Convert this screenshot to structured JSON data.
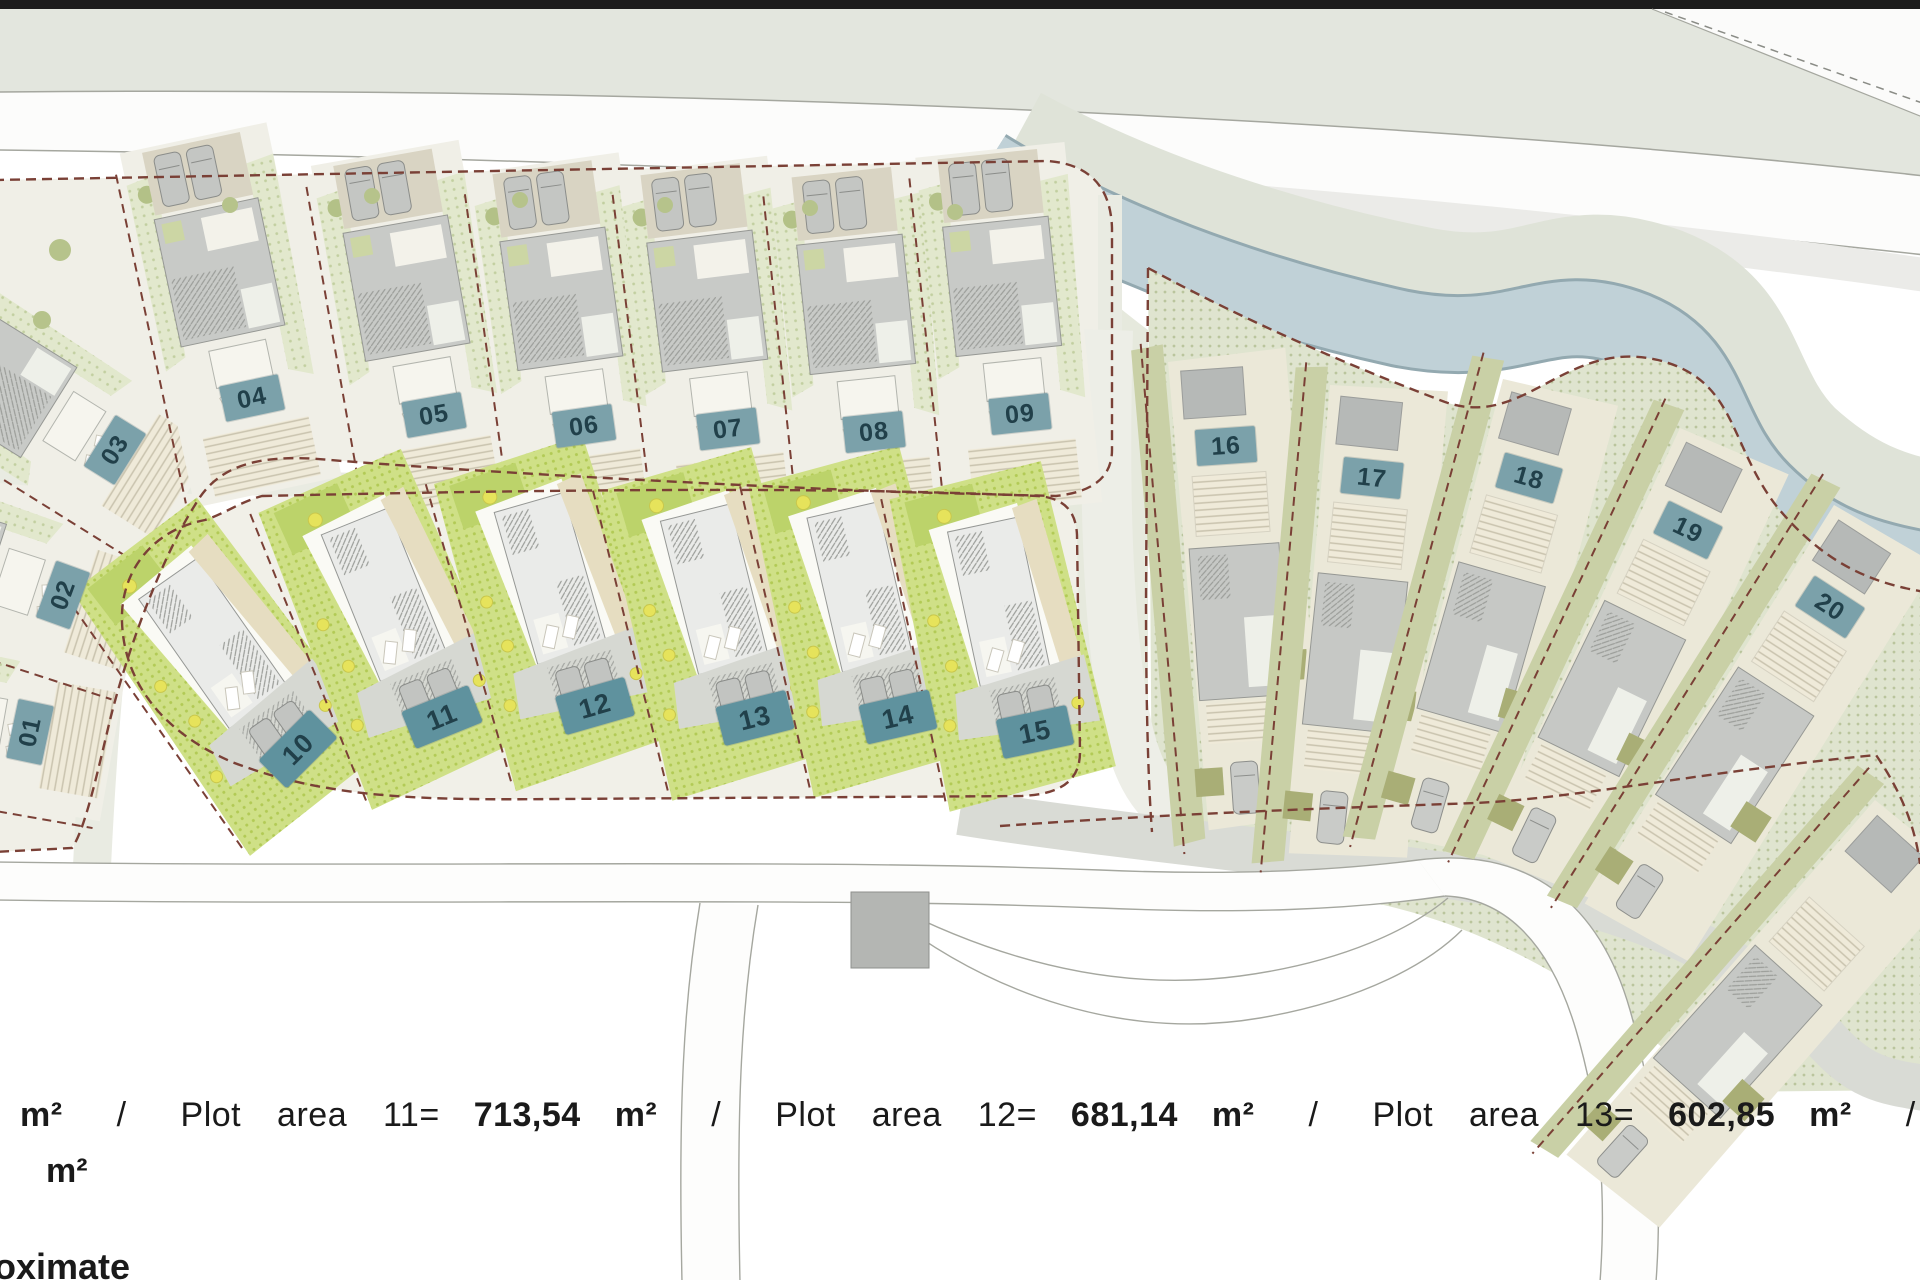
{
  "plan": {
    "type": "residential development site plan",
    "clusters": {
      "upper_row_plots": [
        "01",
        "02",
        "03",
        "04",
        "05",
        "06",
        "07",
        "08",
        "09"
      ],
      "lower_row_plots": [
        "10",
        "11",
        "12",
        "13",
        "14",
        "15"
      ],
      "right_fan_plots": [
        "16",
        "17",
        "18",
        "19",
        "20"
      ]
    }
  },
  "plots": [
    {
      "id": "01"
    },
    {
      "id": "02"
    },
    {
      "id": "03"
    },
    {
      "id": "04"
    },
    {
      "id": "05"
    },
    {
      "id": "06"
    },
    {
      "id": "07"
    },
    {
      "id": "08"
    },
    {
      "id": "09"
    },
    {
      "id": "10"
    },
    {
      "id": "11"
    },
    {
      "id": "12"
    },
    {
      "id": "13"
    },
    {
      "id": "14"
    },
    {
      "id": "15"
    },
    {
      "id": "16"
    },
    {
      "id": "17"
    },
    {
      "id": "18"
    },
    {
      "id": "19"
    },
    {
      "id": "20"
    }
  ],
  "legend": {
    "line1_segments": [
      {
        "text": "m²",
        "bold": true
      },
      {
        "text": "/",
        "bold": false
      },
      {
        "text": "Plot area 11=",
        "bold": false
      },
      {
        "text": "713,54",
        "bold": true
      },
      {
        "text": "m²",
        "bold": true
      },
      {
        "text": "/",
        "bold": false
      },
      {
        "text": "Plot area 12=",
        "bold": false
      },
      {
        "text": "681,14",
        "bold": true
      },
      {
        "text": "m²",
        "bold": true
      },
      {
        "text": "/",
        "bold": false
      },
      {
        "text": "Plot area 13=",
        "bold": false
      },
      {
        "text": "602,85",
        "bold": true
      },
      {
        "text": "m²",
        "bold": true
      },
      {
        "text": "/",
        "bold": false
      },
      {
        "text": "Plot",
        "bold": false
      }
    ],
    "areas_visible": {
      "11": "713,54 m²",
      "12": "681,14 m²",
      "13": "602,85 m²"
    },
    "line2": "m²",
    "line3": "oximate"
  },
  "colors": {
    "badge_teal": "#7ba1aa",
    "pool_teal": "#5f929e",
    "badge_text": "#21404a",
    "boundary_dashed": "#7a4036",
    "river": "#c0d1d7",
    "lower_vegetation": "#cfe087",
    "right_cluster_green": "#dfe4cf",
    "road_gray_green": "#e9ebe2",
    "top_band": "#e3e6de"
  }
}
